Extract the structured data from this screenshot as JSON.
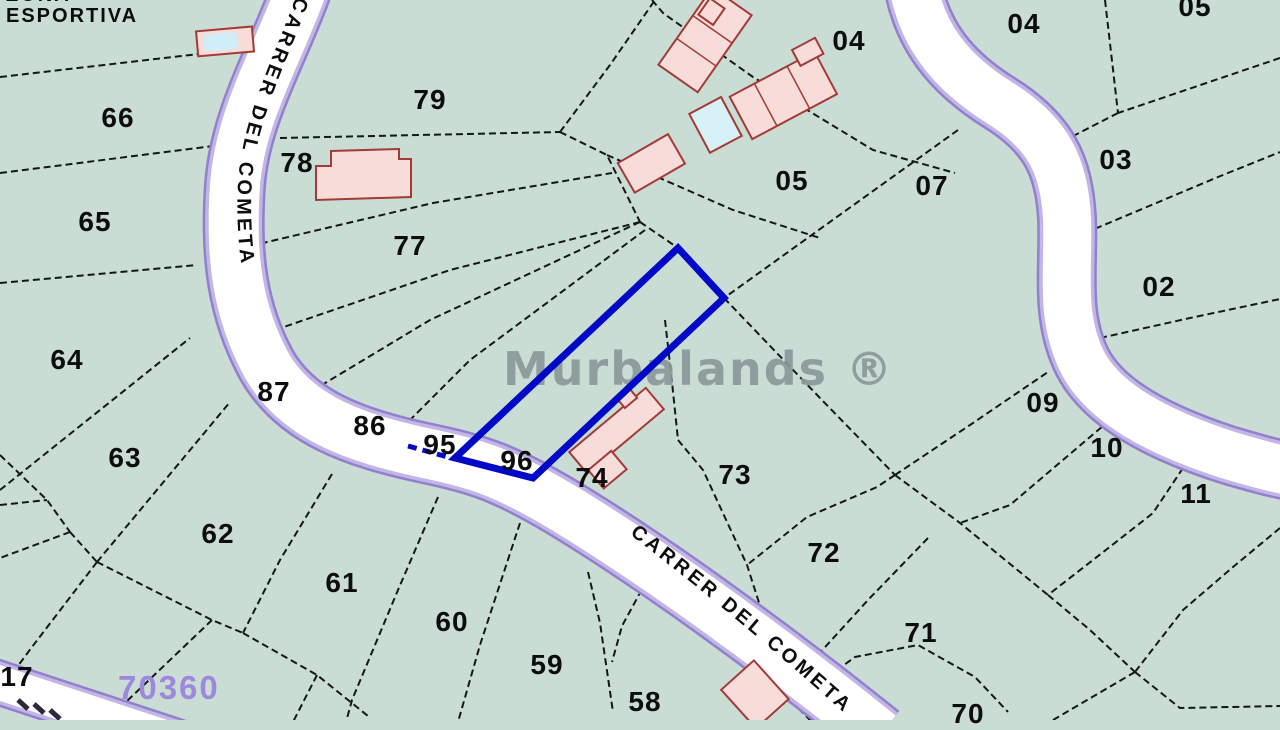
{
  "map": {
    "watermark": "Murbalands ®",
    "zone_label": "ZONA\nESPORTIVA",
    "area_code": "70360",
    "street_vertical": "CARRER DEL COMETA",
    "street_diagonal": "CARRER DEL COMETA",
    "highlighted_parcel": {
      "color": "#0009c8",
      "vertices": "678,248 724,298 533,478 455,458"
    },
    "colors": {
      "land": "#c9ddd4",
      "line": "#161616",
      "ink": "#0d0d0d",
      "road-fill": "#ffffff",
      "road-edge": "#9180cc",
      "road-edge2": "#c3b5e6",
      "bld-fill": "#f8dcda",
      "bld-stroke": "#a23b35",
      "pool": "#d6f1f7",
      "blue": "#0009c8",
      "wm": "#8b989a",
      "purple": "#9d88dc"
    },
    "parcel_labels": [
      {
        "id": "66",
        "x": 118,
        "y": 118
      },
      {
        "id": "65",
        "x": 95,
        "y": 222
      },
      {
        "id": "64",
        "x": 67,
        "y": 360
      },
      {
        "id": "63",
        "x": 125,
        "y": 458
      },
      {
        "id": "62",
        "x": 218,
        "y": 534
      },
      {
        "id": "61",
        "x": 342,
        "y": 583
      },
      {
        "id": "60",
        "x": 452,
        "y": 622
      },
      {
        "id": "59",
        "x": 547,
        "y": 665
      },
      {
        "id": "58",
        "x": 645,
        "y": 702
      },
      {
        "id": "17",
        "x": 17,
        "y": 677
      },
      {
        "id": "79",
        "x": 430,
        "y": 100
      },
      {
        "id": "78",
        "x": 297,
        "y": 163
      },
      {
        "id": "77",
        "x": 410,
        "y": 246
      },
      {
        "id": "87",
        "x": 274,
        "y": 392
      },
      {
        "id": "86",
        "x": 370,
        "y": 426
      },
      {
        "id": "95",
        "x": 440,
        "y": 445
      },
      {
        "id": "96",
        "x": 517,
        "y": 461
      },
      {
        "id": "74",
        "x": 592,
        "y": 478
      },
      {
        "id": "73",
        "x": 735,
        "y": 475
      },
      {
        "id": "72",
        "x": 824,
        "y": 553
      },
      {
        "id": "71",
        "x": 921,
        "y": 633
      },
      {
        "id": "70",
        "x": 968,
        "y": 714
      },
      {
        "id": "05",
        "x": 792,
        "y": 181
      },
      {
        "id": "07",
        "x": 932,
        "y": 186
      },
      {
        "id": "04",
        "x": 849,
        "y": 41
      },
      {
        "id": "04",
        "x": 1024,
        "y": 24
      },
      {
        "id": "03",
        "x": 1116,
        "y": 160
      },
      {
        "id": "02",
        "x": 1159,
        "y": 287
      },
      {
        "id": "09",
        "x": 1043,
        "y": 403
      },
      {
        "id": "10",
        "x": 1107,
        "y": 448
      },
      {
        "id": "11",
        "x": 1196,
        "y": 494
      },
      {
        "id": "05",
        "x": 1195,
        "y": 7
      }
    ]
  }
}
